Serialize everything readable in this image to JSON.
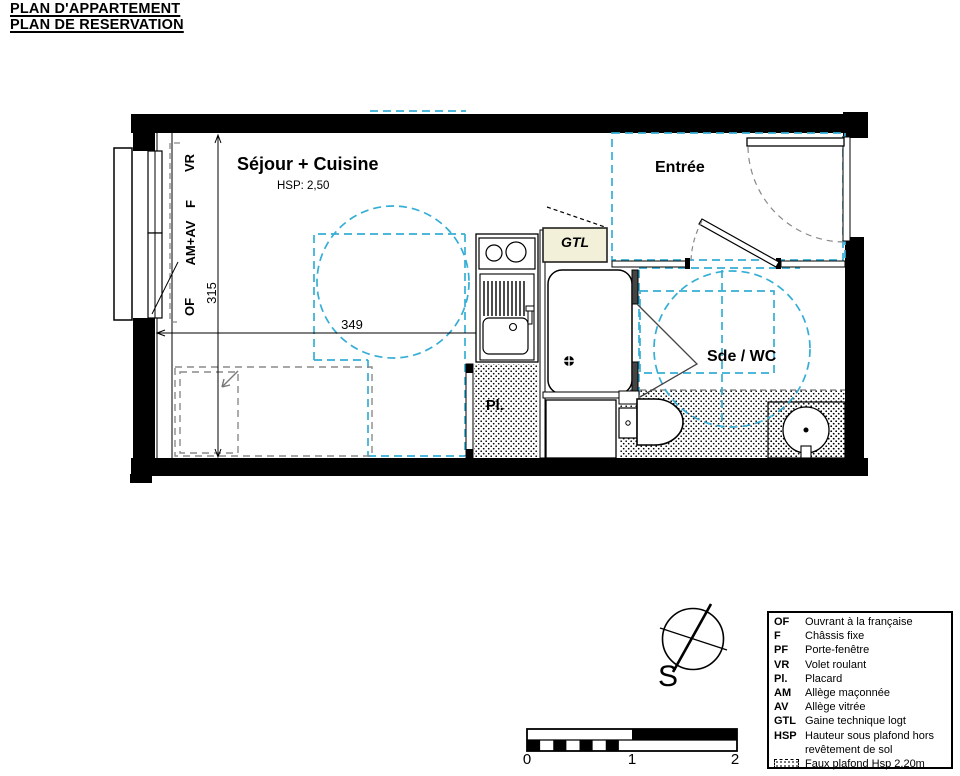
{
  "header": {
    "title_line1": "PLAN D'APPARTEMENT",
    "title_line2": "PLAN DE RESERVATION"
  },
  "plan": {
    "rooms": {
      "sejour": {
        "name": "Séjour + Cuisine",
        "hsp": "HSP: 2,50"
      },
      "entree": {
        "name": "Entrée"
      },
      "sde_wc": {
        "name": "Sde / WC"
      },
      "placard": {
        "abbr": "Pl."
      },
      "gtl": {
        "abbr": "GTL"
      }
    },
    "window_labels": {
      "vr": "VR",
      "f": "F",
      "am_av": "AM+AV",
      "of": "OF"
    },
    "dimensions": {
      "width_cm": "349",
      "height_cm": "315"
    },
    "colors": {
      "wall": "#000000",
      "faux_plafond_line": "#35aed6",
      "gtl_fill": "#f3f0da",
      "furniture_dash": "#8a8a8a"
    }
  },
  "compass": {
    "south_label": "S"
  },
  "scale_bar": {
    "ticks": [
      "0",
      "1",
      "2"
    ]
  },
  "legend": {
    "items": [
      {
        "abbr": "OF",
        "desc": "Ouvrant à la française"
      },
      {
        "abbr": "F",
        "desc": "Châssis fixe"
      },
      {
        "abbr": "PF",
        "desc": "Porte-fenêtre"
      },
      {
        "abbr": "VR",
        "desc": "Volet roulant"
      },
      {
        "abbr": "Pl.",
        "desc": "Placard"
      },
      {
        "abbr": "AM",
        "desc": "Allège maçonnée"
      },
      {
        "abbr": "AV",
        "desc": "Allège vitrée"
      },
      {
        "abbr": "GTL",
        "desc": "Gaine technique logt"
      },
      {
        "abbr": "HSP",
        "desc": "Hauteur sous plafond hors revêtement de sol"
      },
      {
        "abbr": "",
        "desc": "Faux plafond Hsp 2,20m"
      }
    ]
  }
}
